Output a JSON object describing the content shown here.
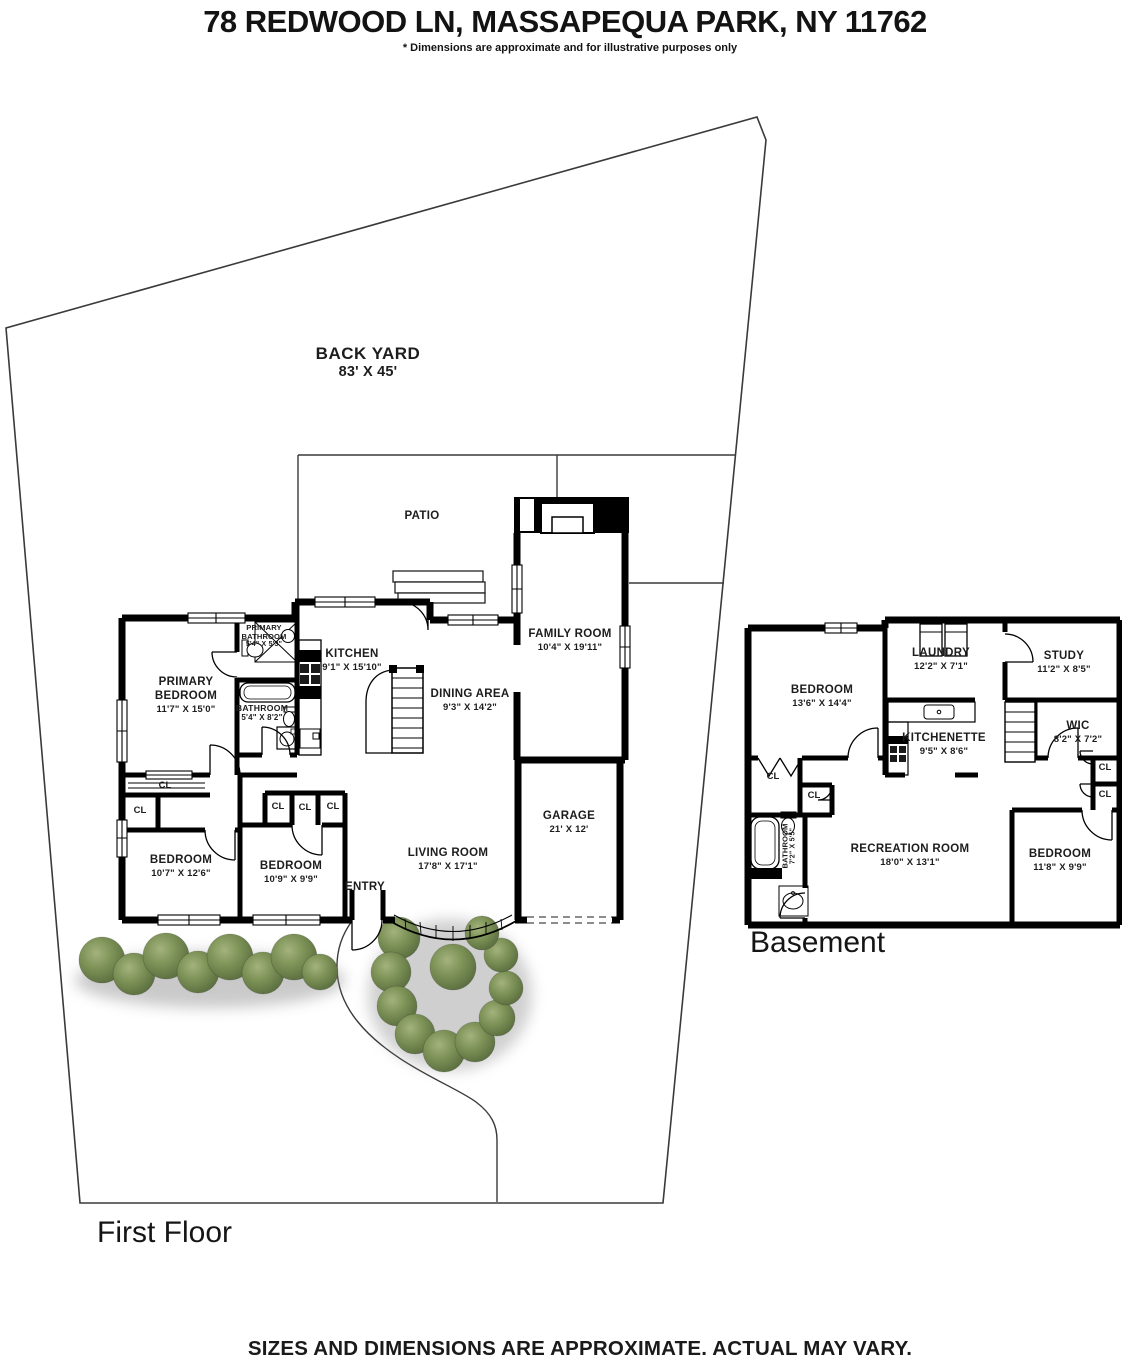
{
  "header": {
    "title": "78 REDWOOD LN, MASSAPEQUA PARK, NY 11762",
    "disclaimer": "* Dimensions are approximate and for illustrative purposes only"
  },
  "footer": {
    "note": "SIZES AND DIMENSIONS ARE APPROXIMATE. ACTUAL MAY VARY."
  },
  "captions": {
    "first_floor": "First Floor",
    "basement": "Basement"
  },
  "yard": {
    "back_yard": "BACK YARD",
    "back_yard_dims": "83' X 45'",
    "patio": "PATIO",
    "entry": "ENTRY",
    "closet": "CL"
  },
  "first_floor": {
    "primary_bedroom": {
      "line1": "PRIMARY",
      "line2": "BEDROOM",
      "dims": "11'7\" X 15'0\""
    },
    "primary_bathroom": {
      "line1": "PRIMARY",
      "line2": "BATHROOM",
      "dims": "5'4\" X 5'3\""
    },
    "bathroom": {
      "name": "BATHROOM",
      "dims": "5'4\" X 8'2\""
    },
    "kitchen": {
      "name": "KITCHEN",
      "dims": "9'1\" X 15'10\""
    },
    "dining_area": {
      "name": "DINING AREA",
      "dims": "9'3\" X 14'2\""
    },
    "family_room": {
      "name": "FAMILY ROOM",
      "dims": "10'4\" X 19'11\""
    },
    "living_room": {
      "name": "LIVING ROOM",
      "dims": "17'8\" X 17'1\""
    },
    "garage": {
      "name": "GARAGE",
      "dims": "21' X 12'"
    },
    "bedroom_left": {
      "name": "BEDROOM",
      "dims": "10'7\" X 12'6\""
    },
    "bedroom_middle": {
      "name": "BEDROOM",
      "dims": "10'9\" X 9'9\""
    }
  },
  "basement": {
    "bedroom": {
      "name": "BEDROOM",
      "dims": "13'6\" X 14'4\""
    },
    "laundry": {
      "name": "LAUNDRY",
      "dims": "12'2\" X 7'1\""
    },
    "study": {
      "name": "STUDY",
      "dims": "11'2\" X 8'5\""
    },
    "kitchenette": {
      "name": "KITCHENETTE",
      "dims": "9'5\" X 8'6\""
    },
    "wic": {
      "name": "WIC",
      "dims": "8'2\" X 7'2\""
    },
    "recreation_room": {
      "name": "RECREATION ROOM",
      "dims": "18'0\" X 13'1\""
    },
    "bedroom_right": {
      "name": "BEDROOM",
      "dims": "11'8\" X 9'9\""
    },
    "bathroom": {
      "name": "BATHROOM",
      "dims": "7'2\" X 5'5\""
    }
  },
  "colors": {
    "wall": "#000000",
    "boundary": "#3a3a3a",
    "bush_light": "#a3b37d",
    "bush_dark": "#55683c",
    "text": "#1d1d1d"
  }
}
